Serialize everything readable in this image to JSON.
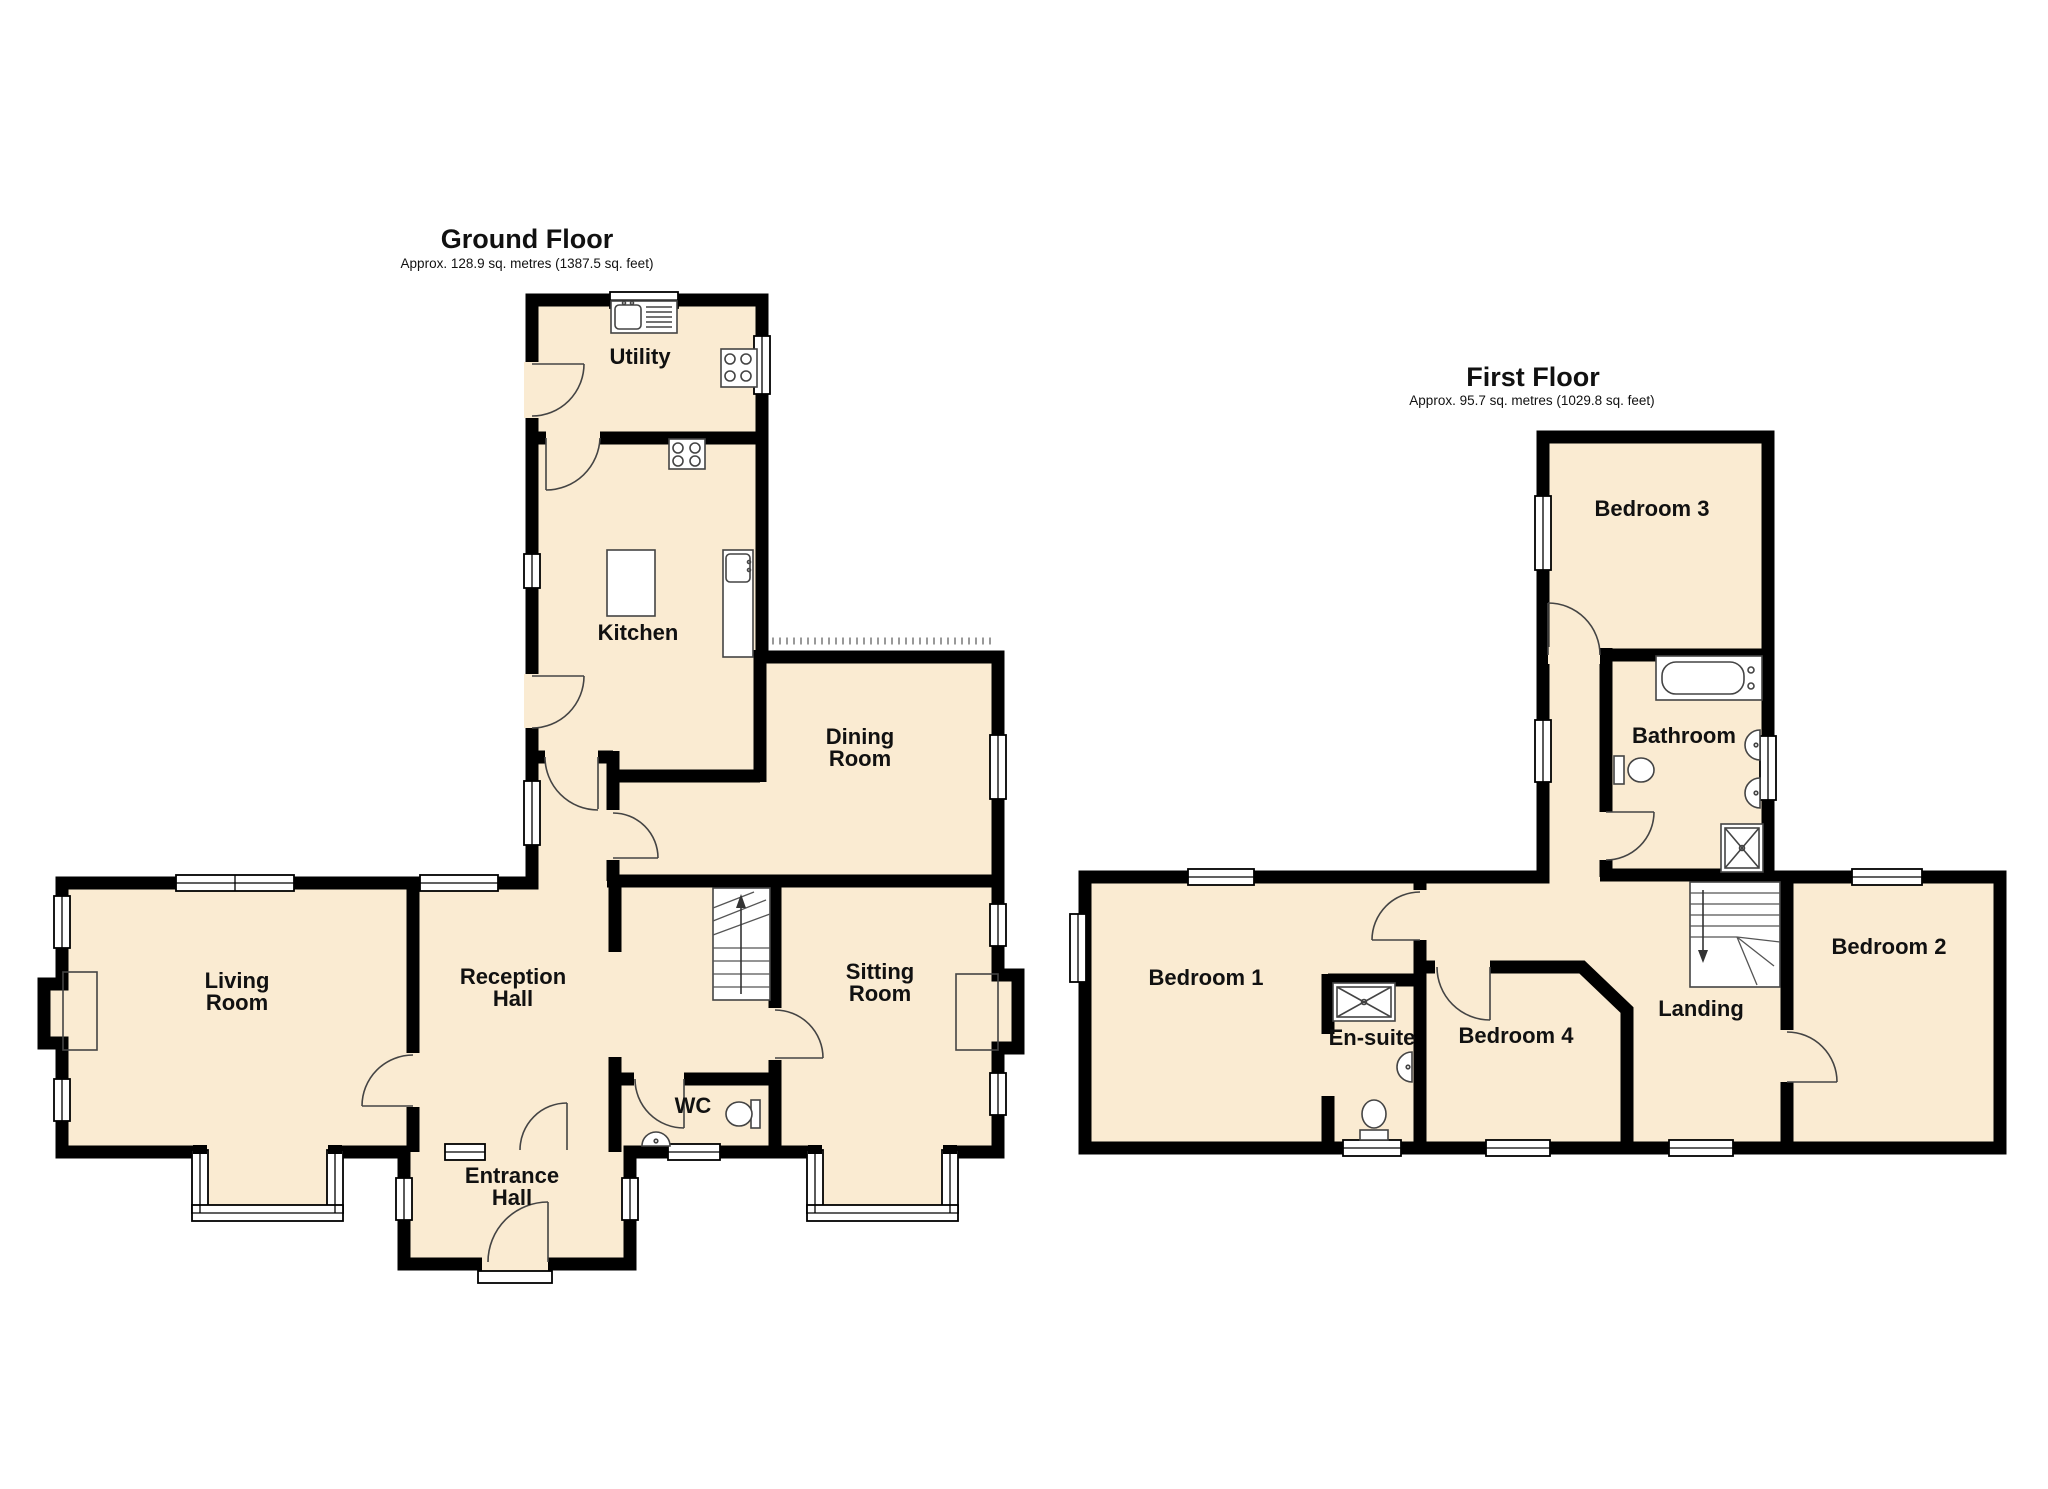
{
  "ground_floor": {
    "title": "Ground Floor",
    "area_note": "Approx. 128.9 sq. metres (1387.5 sq. feet)",
    "rooms": {
      "utility": "Utility",
      "kitchen": "Kitchen",
      "dining": [
        "Dining",
        "Room"
      ],
      "living": [
        "Living",
        "Room"
      ],
      "reception": [
        "Reception",
        "Hall"
      ],
      "sitting": [
        "Sitting",
        "Room"
      ],
      "entrance": [
        "Entrance",
        "Hall"
      ],
      "wc": "WC"
    },
    "fixtures": [
      "sink-drainer-icon",
      "hob-icon",
      "sink-icon",
      "island-counter",
      "fireplace-icon",
      "stairs-up-icon",
      "toilet-icon",
      "basin-icon",
      "bay-window",
      "front-door"
    ]
  },
  "first_floor": {
    "title": "First Floor",
    "area_note": "Approx. 95.7 sq. metres (1029.8 sq. feet)",
    "rooms": {
      "bedroom1": "Bedroom 1",
      "bedroom2": "Bedroom 2",
      "bedroom3": "Bedroom 3",
      "bedroom4": "Bedroom 4",
      "bathroom": "Bathroom",
      "ensuite": "En-suite",
      "landing": "Landing"
    },
    "fixtures": [
      "bath-icon",
      "toilet-icon",
      "basin-icon",
      "shower-icon",
      "stairs-down-icon"
    ]
  },
  "style": {
    "room_fill": "#FAEBD2",
    "wall_color": "#000000",
    "label_color": "#111111",
    "fixture_line_color": "#444444"
  }
}
